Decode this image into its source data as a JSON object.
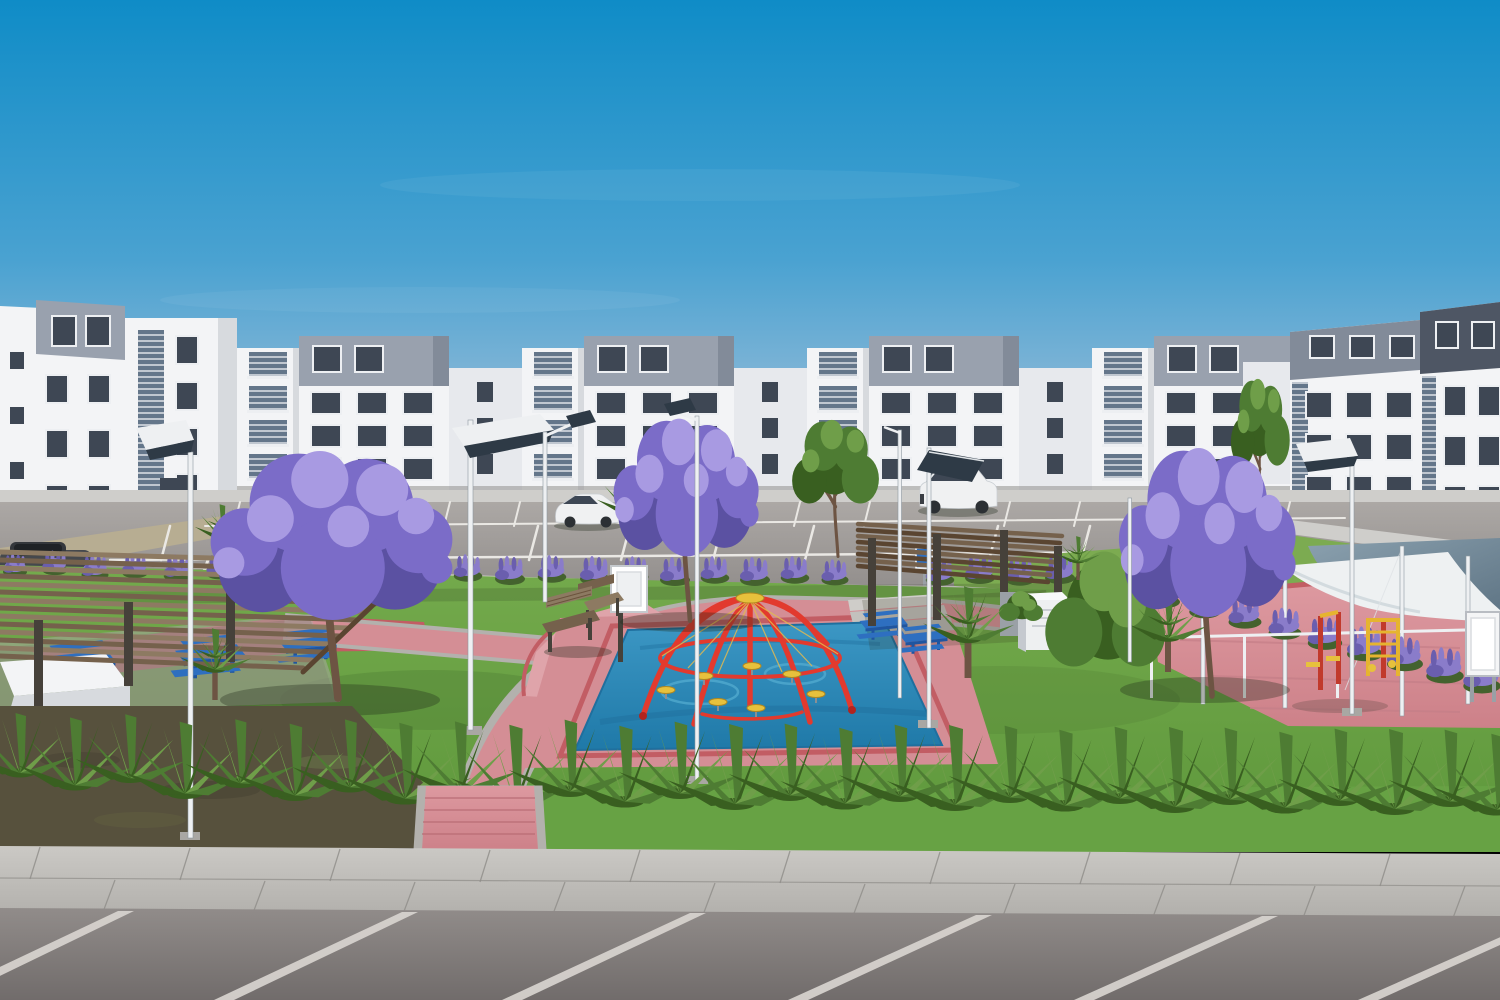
{
  "scene": {
    "type": "architectural-render",
    "description": "3D rendering of a residential apartment complex: white four-story apartment buildings with gray rooftop volumes surround a landscaped courtyard park featuring purple jacaranda trees, lavender hedges, a blue splash-pad playground with a red climbing dome and yellow step discs, wooden pergolas with blue picnic tables, white shade sails over a red-and-yellow outdoor gym, solar street lamps, a parking lot with white cars, an agave hedge row, and a foreground sidewalk with angled parking stalls.",
    "objects": [
      {
        "id": "sky",
        "label": "clear blue sky"
      },
      {
        "id": "apartment-buildings",
        "label": "white four-story apartment blocks with gray roof volumes"
      },
      {
        "id": "parking-lot",
        "label": "rear parking lot with white stall stripes"
      },
      {
        "id": "cars",
        "label": "white hatchback, white SUV, dark parked car"
      },
      {
        "id": "solar-street-lamps",
        "label": "white poles with tilted solar panels"
      },
      {
        "id": "jacaranda-trees",
        "label": "trees with purple blossoms"
      },
      {
        "id": "lavender-hedge",
        "label": "rows of purple lavender shrubs"
      },
      {
        "id": "pergolas",
        "label": "brown slatted wood pergolas"
      },
      {
        "id": "picnic-tables",
        "label": "blue metal picnic tables"
      },
      {
        "id": "splash-pad",
        "label": "blue playground surface"
      },
      {
        "id": "climbing-dome",
        "label": "red dome climber with yellow discs"
      },
      {
        "id": "shade-sails",
        "label": "white tensile shade canopies"
      },
      {
        "id": "outdoor-gym",
        "label": "red and yellow exercise equipment"
      },
      {
        "id": "agave-row",
        "label": "hedge of spiky green agaves"
      },
      {
        "id": "pink-paths",
        "label": "pink paver walkways with concrete borders"
      },
      {
        "id": "sidewalk",
        "label": "concrete sidewalk with expansion joints"
      },
      {
        "id": "foreground-parking",
        "label": "asphalt with angled white stall stripes"
      }
    ],
    "palette": {
      "sky_top": "#0f8cc7",
      "sky_mid": "#4aa2d1",
      "sky_low": "#93bbd8",
      "sky_horizon": "#c2cdd9",
      "bldg_lit": "#f3f4f6",
      "bldg_shade": "#d7dade",
      "bldg_recess": "#e7e9ed",
      "cap": "#99a1ae",
      "cap_shade": "#828b99",
      "cap_dark": "#4e5664",
      "glass": "#3e4754",
      "glass_lt": "#64768a",
      "frame": "#edeff2",
      "apron": "#cfcecb",
      "sand": "#b7ad92",
      "asphalt": "#a39f9d",
      "asphalt_dark": "#8f8b89",
      "lane_stripe": "#eae8e4",
      "curb": "#d7d5d1",
      "grass": "#6ca547",
      "grass_dark": "#4e7c33",
      "slope_grass": "#7cab51",
      "grass_fore": "#67a244",
      "dirt": "#57513d",
      "lavender": "#8a7cca",
      "lavender_dark": "#6a5eae",
      "lavender_green": "#44622e",
      "tree_purple": "#7b6cc8",
      "tree_purple_light": "#a89ae2",
      "tree_purple_dark": "#5b51a2",
      "tree_green": "#4e7c33",
      "tree_green_light": "#6f9e49",
      "tree_green_dark": "#395f20",
      "trunk": "#6d5443",
      "wood_light": "#8d7a62",
      "wood": "#75614c",
      "wood_dark": "#5a4531",
      "post_dark": "#46413a",
      "table_blue": "#2e6fc0",
      "table_blue_dark": "#1f55a0",
      "mat_blue": "#2b86b6",
      "mat_blue_light": "#55aed2",
      "mat_blue_dark": "#1f6f9e",
      "dome_red": "#e23a2e",
      "dome_red_dark": "#b2241f",
      "disc_yellow": "#e7c13c",
      "cable_yellow": "#e3b94f",
      "path_pink": "#d48e95",
      "path_pink_light": "#dfa4aa",
      "paver_red": "#c25d64",
      "paver_red_dark": "#a84850",
      "walk": "#c6c4c0",
      "walk_dark": "#b3b1ad",
      "walk_joint": "#8f8d89",
      "fore_asphalt": "#8a8482",
      "fore_asphalt_dark": "#6f6a69",
      "fore_stripe": "#d8d4cf",
      "sail_white": "#eef1f2",
      "sail_shade": "#ccd6da",
      "sail_dark": "#5e7484",
      "sail_dark_light": "#8ba1af",
      "equip_red": "#c13a2c",
      "equip_yellow": "#e6b42f",
      "metal_white": "#eef0f2",
      "panel_dark": "#2e3a46",
      "concrete_pad": "#a9a7a3",
      "car_white": "#f0f1f2",
      "car_dark": "#45484d",
      "shadow": "rgba(30,40,25,0.32)"
    }
  }
}
